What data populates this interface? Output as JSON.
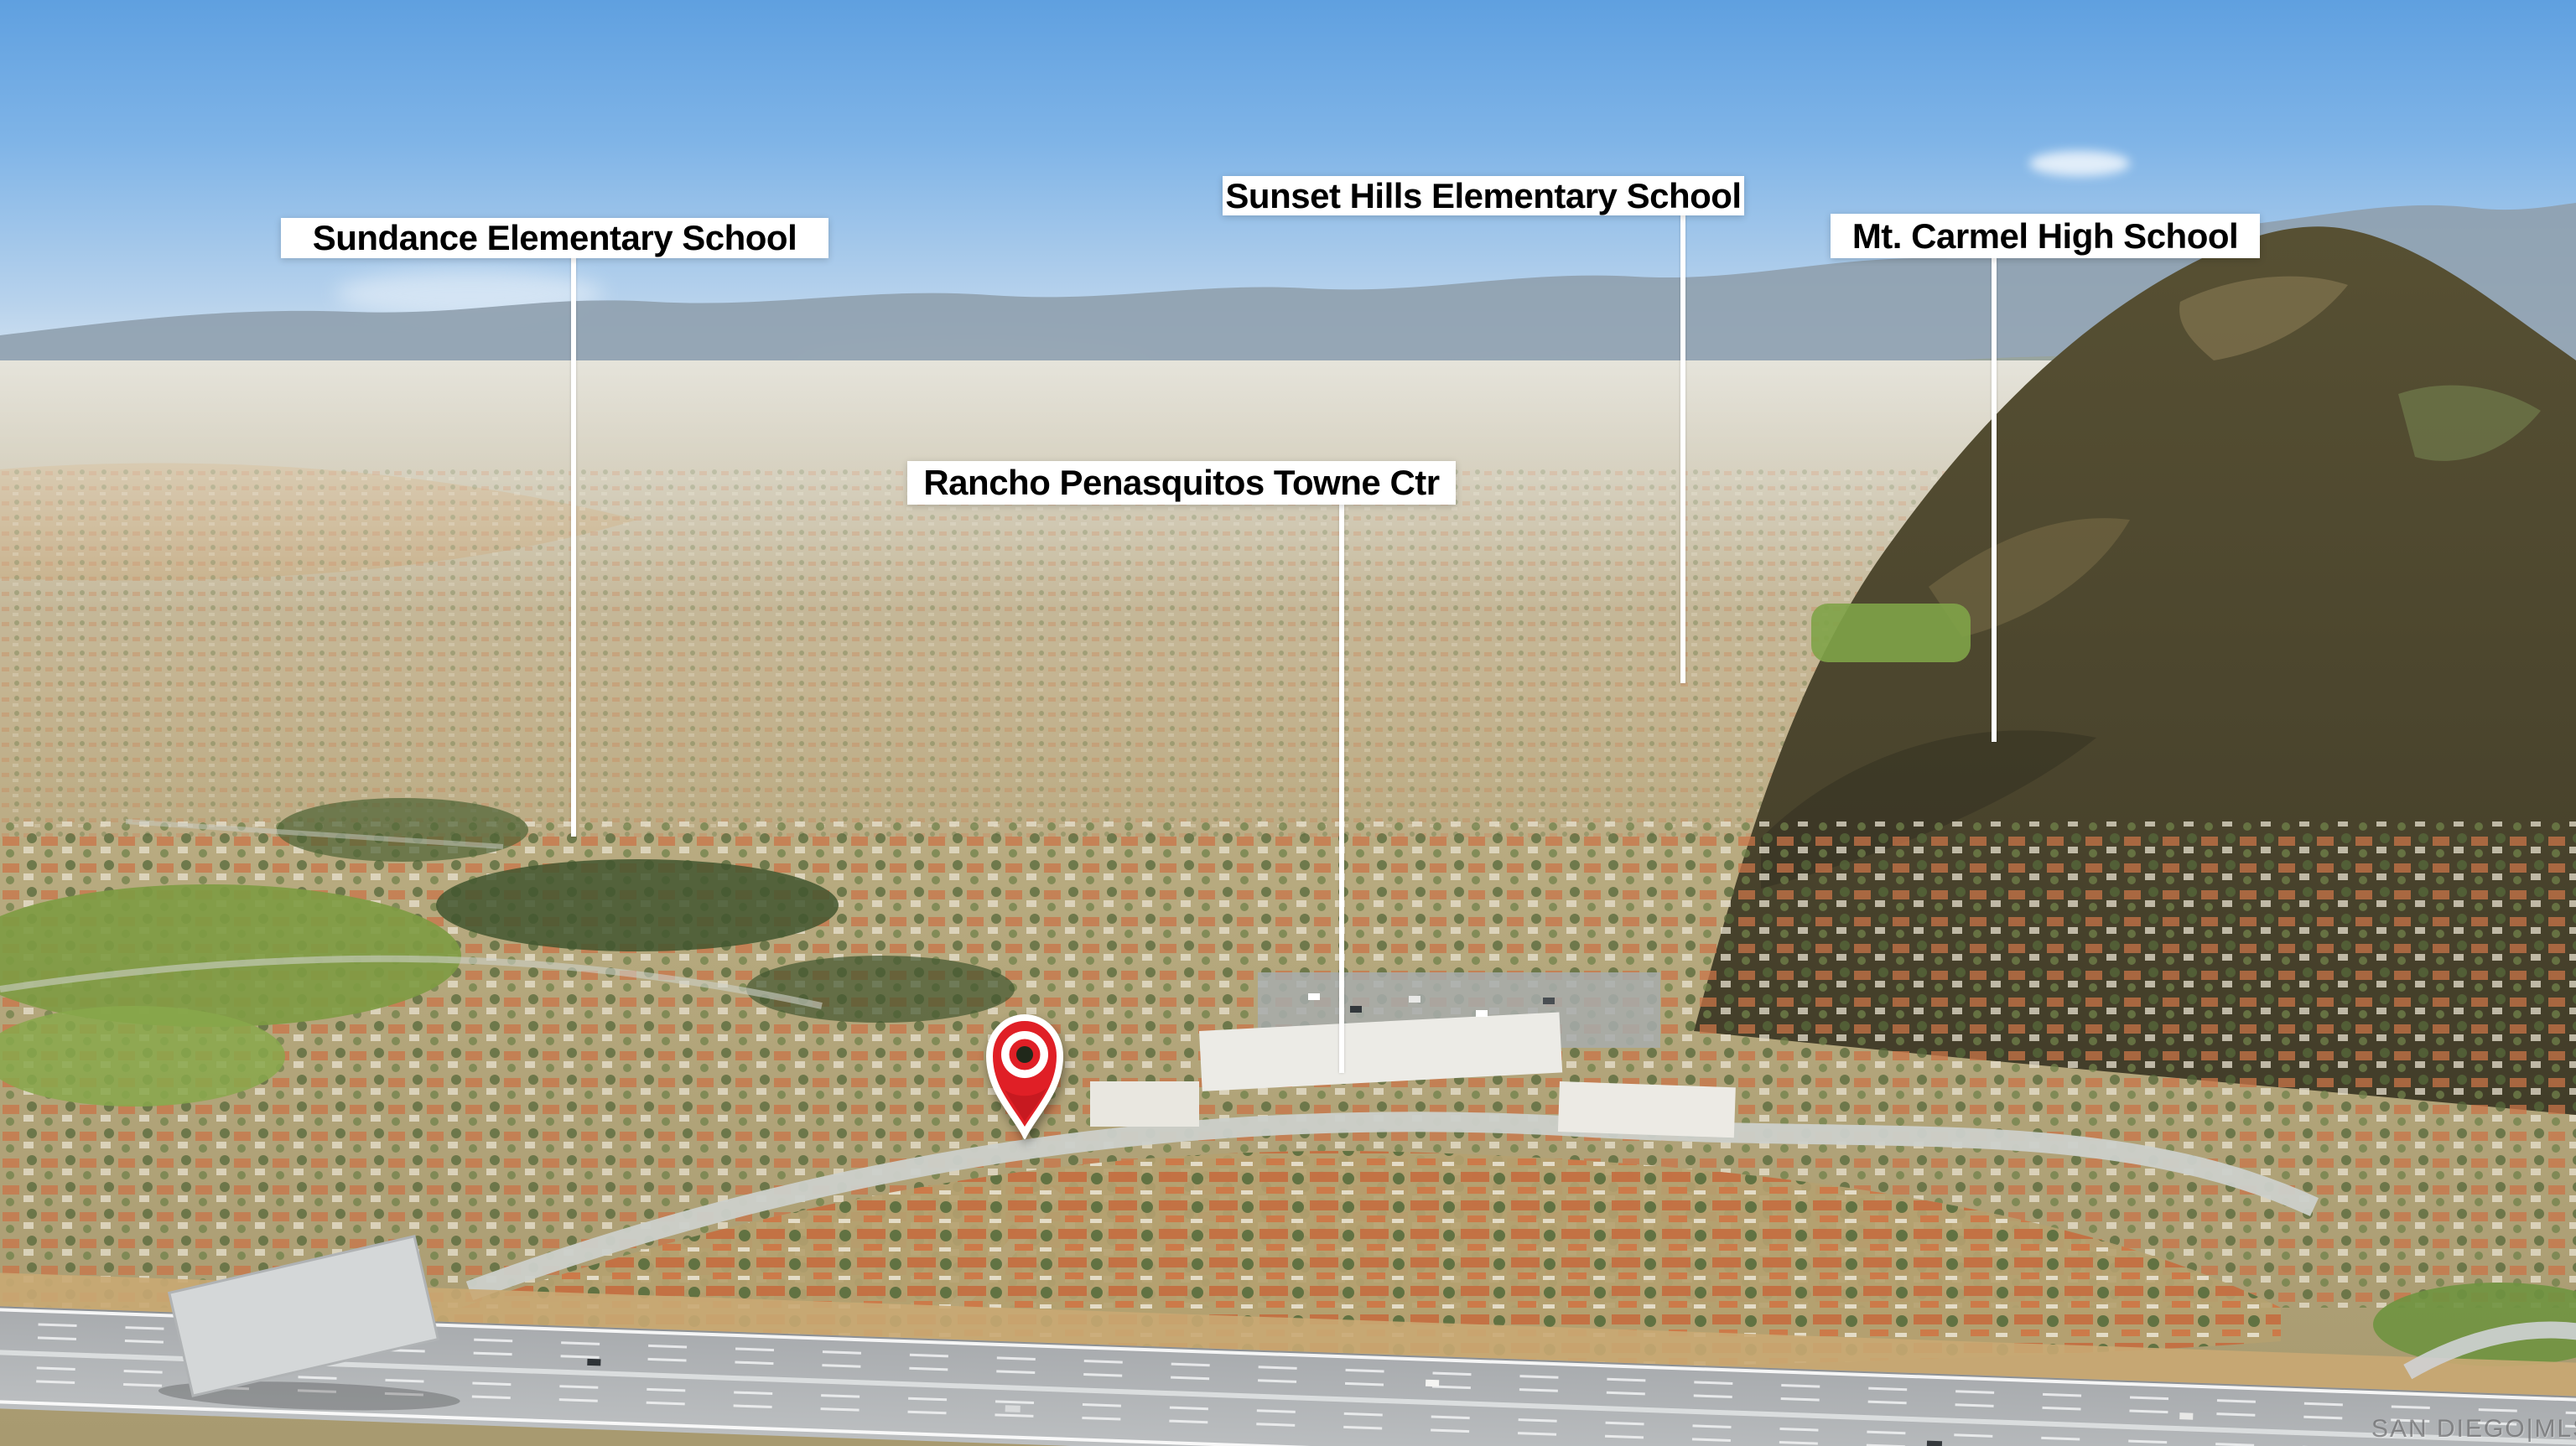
{
  "annotations": {
    "labels": [
      {
        "id": "sundance-elementary-school",
        "text": "Sundance Elementary School"
      },
      {
        "id": "sunset-hills-elementary-school",
        "text": "Sunset Hills Elementary School"
      },
      {
        "id": "mt-carmel-high-school",
        "text": "Mt. Carmel High School"
      },
      {
        "id": "rancho-penasquitos-towne-ctr",
        "text": "Rancho Penasquitos Towne Ctr"
      }
    ],
    "pin": {
      "icon": "map-pin",
      "color": "#e01f26"
    }
  },
  "watermark": {
    "text": "SAN DIEGO|MLS"
  },
  "colors": {
    "label_background": "#ffffff",
    "label_text": "#000000",
    "leader_line": "#ffffff",
    "pin_red": "#e01f26",
    "pin_center_dark": "#20281a",
    "sky_blue": "#6fa9e3",
    "mountain_olive": "#4c4630",
    "watermark_gray": "#58585a"
  }
}
